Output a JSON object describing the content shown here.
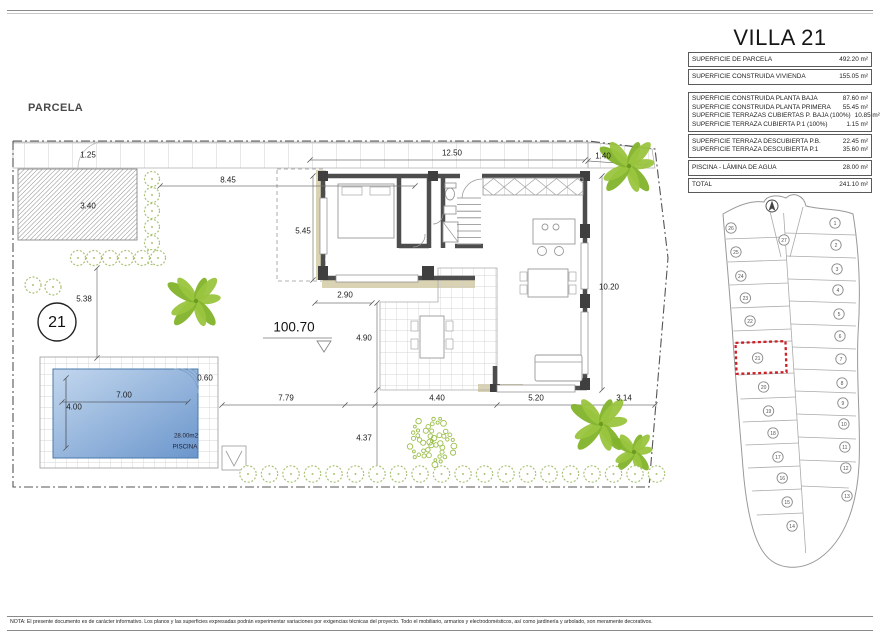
{
  "title": "VILLA 21",
  "parcela_label": "PARCELA",
  "note": "NOTA: El presente documento es de carácter informativo. Los planos y las superficies expresadas podrán experimentar variaciones por exigencias técnicas del proyecto. Todo el mobiliario, armarios y electrodomésticos, así como jardinería y arbolado, son meramente decorativos.",
  "areas_table": {
    "groups": [
      {
        "rows": [
          {
            "label": "SUPERFICIE DE PARCELA",
            "value": "492.20 m²"
          }
        ]
      },
      {
        "rows": [
          {
            "label": "SUPERFICIE CONSTRUIDA VIVIENDA",
            "value": "155.05 m²"
          }
        ]
      },
      {
        "rows": [
          {
            "label": "SUPERFICIE CONSTRUIDA PLANTA BAJA",
            "value": "87.60 m²"
          },
          {
            "label": "SUPERFICIE CONSTRUIDA PLANTA PRIMERA",
            "value": "55.45 m²"
          },
          {
            "label": "SUPERFICIE TERRAZAS CUBIERTAS P. BAJA (100%)",
            "value": "10.85 m²"
          },
          {
            "label": "SUPERFICIE TERRAZA CUBIERTA P.1 (100%)",
            "value": "1.15 m²"
          }
        ]
      },
      {
        "rows": [
          {
            "label": "SUPERFICIE TERRAZA DESCUBIERTA P.B.",
            "value": "22.45 m²"
          },
          {
            "label": "SUPERFICIE TERRAZA DESCUBIERTA P.1",
            "value": "35.60 m²"
          }
        ]
      },
      {
        "rows": [
          {
            "label": "PISCINA - LÁMINA DE AGUA",
            "value": "28.00 m²"
          }
        ]
      },
      {
        "rows": [
          {
            "label": "TOTAL",
            "value": "241.10 m²"
          }
        ]
      }
    ]
  },
  "plan": {
    "plot_number": "21",
    "level": "100.70",
    "dimensions": [
      {
        "name": "dim-1-25",
        "text": "1.25"
      },
      {
        "name": "dim-12-50",
        "text": "12.50"
      },
      {
        "name": "dim-1-40",
        "text": "1.40"
      },
      {
        "name": "dim-8-45",
        "text": "8.45"
      },
      {
        "name": "dim-3-40",
        "text": "3.40"
      },
      {
        "name": "dim-5-45",
        "text": "5.45"
      },
      {
        "name": "dim-2-90",
        "text": "2.90"
      },
      {
        "name": "dim-5-38",
        "text": "5.38"
      },
      {
        "name": "dim-4-90",
        "text": "4.90"
      },
      {
        "name": "dim-10-20",
        "text": "10.20"
      },
      {
        "name": "dim-7-79",
        "text": "7.79"
      },
      {
        "name": "dim-4-40",
        "text": "4.40"
      },
      {
        "name": "dim-5-20",
        "text": "5.20"
      },
      {
        "name": "dim-3-14",
        "text": "3.14"
      },
      {
        "name": "dim-4-37",
        "text": "4.37"
      },
      {
        "name": "dim-7-00",
        "text": "7.00"
      },
      {
        "name": "dim-4-00",
        "text": "4.00"
      },
      {
        "name": "dim-0-60",
        "text": "0.60"
      },
      {
        "name": "pool-area-label",
        "text": "28.00m2"
      },
      {
        "name": "pool-name-label",
        "text": "PISCINA"
      }
    ]
  },
  "map": {
    "plot_top": "27",
    "plots_left": [
      "26",
      "25",
      "24",
      "23",
      "22",
      "21",
      "20",
      "19",
      "18",
      "17",
      "16",
      "15",
      "14"
    ],
    "plots_right": [
      "1",
      "2",
      "3",
      "4",
      "5",
      "6",
      "7",
      "8",
      "9",
      "10",
      "11",
      "12",
      "13"
    ],
    "highlighted_plot": "21"
  },
  "colors": {
    "wall": "#4d4d4d",
    "beige": "#d9d3b4",
    "pool_light": "#c3d7ee",
    "pool_dark": "#6b96cc",
    "tree_green_1": "#82b32b",
    "tree_green_2": "#9ac43e",
    "bush_green": "#a9c375",
    "highlight_red": "#cc2027"
  }
}
